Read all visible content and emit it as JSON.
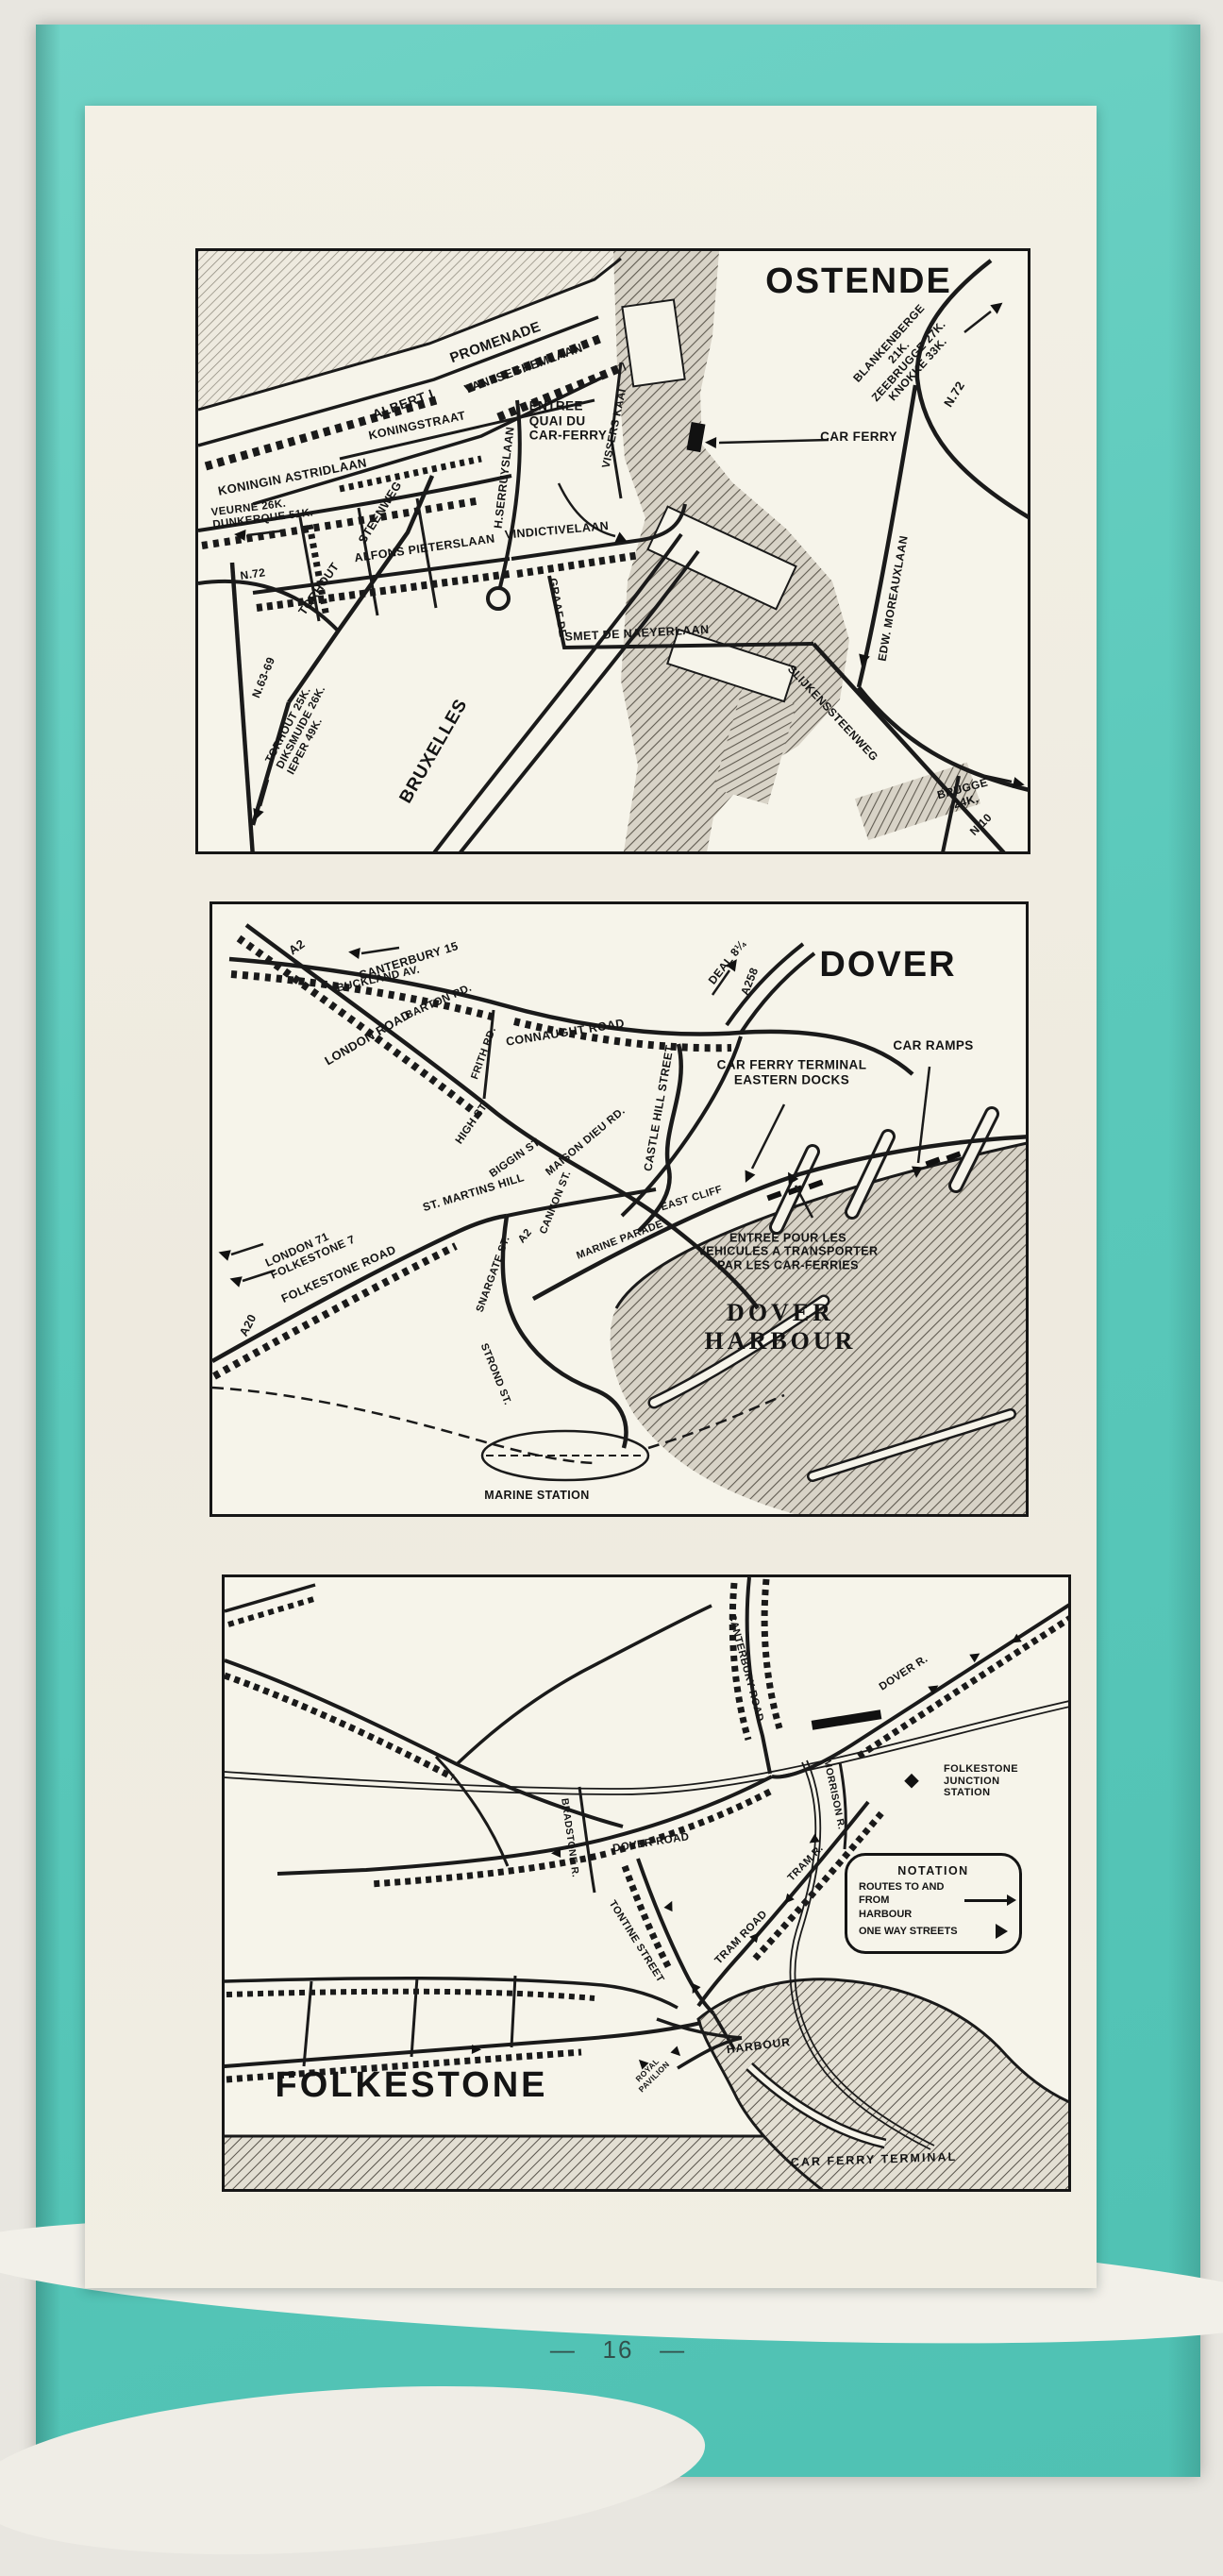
{
  "page": {
    "number_label": "—   16   —"
  },
  "colors": {
    "teal": "#5bc9bb",
    "paper": "#f2efe4",
    "ink": "#161616",
    "water_hatch": "#d8d3c7"
  },
  "maps": {
    "ostende": {
      "title": "OSTENDE",
      "labels": {
        "promenade": "PROMENADE",
        "albert": "ALBERT I",
        "van_iseghemlaan": "VAN ISEGHEMLAAN",
        "koningstraat": "KONINGSTRAAT",
        "entree": "ENTREE\nQUAI DU\nCAR-FERRY",
        "koningin_astridlaan": "KONINGIN ASTRIDLAAN",
        "veurne_dunkerque": "VEURNE 26K.\nDUNKERQUE 51K.",
        "h_serruyslaan": "H.SERRUYSLAAN",
        "vindictivelaan": "VINDICTIVELAAN",
        "alfons_pieterslaan": "ALFONS PIETERSLAAN",
        "steenweg": "STEENWEG",
        "torhout_street": "TORHOUT",
        "n72_left": "N.72",
        "n63_69": "N.63-69",
        "torhout_distances": "TORHOUT 25K.\nDIKSMUIDE 26K.\nIEPER 49K.",
        "bruxelles": "BRUXELLES",
        "vissers_kaai": "VISSERS KAAI",
        "car_ferry": "CAR FERRY",
        "blankenberge_knokke": "BLANKENBERGE 21K.\nZEEBRUGGE 27K.\nKNOKKE 33K.",
        "n72_right": "N.72",
        "graaf_de": "GRAAF DE",
        "smet_de_naeyerlaan": "SMET DE NAEYERLAAN",
        "slijkenssteenweg": "SLIJKENSSTEENWEG",
        "edw_moreauxlaan": "EDW. MOREAUXLAAN",
        "brugge": "BRUGGE 24K.",
        "n10": "N.10"
      }
    },
    "dover": {
      "title": "DOVER",
      "labels": {
        "a2_nw": "A2",
        "canterbury": "CANTERBURY 15",
        "buckland": "BUCKLAND AV.",
        "barton": "BARTON RD.",
        "london_road": "LONDON ROAD",
        "connaught": "CONNAUGHT ROAD",
        "frith": "FRITH RD.",
        "castle_hill": "CASTLE HILL STREET",
        "deal": "DEAL 8¼",
        "a258": "A258",
        "high_st": "HIGH ST.",
        "biggin": "BIGGIN ST.",
        "cannon": "CANNON ST.",
        "maison_dieu": "MAISON DIEU RD.",
        "st_martins": "ST. MARTINS HILL",
        "london_folkestone": "LONDON 71\nFOLKESTONE 7",
        "a20": "A20",
        "folkestone_road": "FOLKESTONE ROAD",
        "snargate": "SNARGATE ST.",
        "a2_snargate": "A2",
        "marine_parade": "MARINE PARADE",
        "east_cliff": "EAST CLIFF",
        "car_ferry_terminal": "CAR FERRY TERMINAL\nEASTERN DOCKS",
        "car_ramps": "CAR RAMPS",
        "entree": "ENTREE POUR LES\nVEHICULES A TRANSPORTER\nPAR LES CAR-FERRIES",
        "dover_harbour": "DOVER HARBOUR",
        "strond": "STROND ST.",
        "marine_station": "MARINE STATION"
      }
    },
    "folkestone": {
      "title": "FOLKESTONE",
      "labels": {
        "canterbury_road": "CANTERBURY ROAD",
        "dover_r": "DOVER R.",
        "junction_station": "FOLKESTONE\nJUNCTION STATION",
        "morrison": "MORRISON R.",
        "dover_road": "DOVER ROAD",
        "bradstone": "BRADSTONE R.",
        "tontine": "TONTINE STREET",
        "tram_road": "TRAM ROAD",
        "tram_r": "TRAM R.",
        "harbour": "HARBOUR",
        "royal_pavilion": "ROYAL\nPAVILION",
        "car_ferry_terminal": "CAR FERRY TERMINAL"
      },
      "notation": {
        "title": "NOTATION",
        "routes": "ROUTES TO AND FROM\nHARBOUR",
        "one_way": "ONE WAY STREETS"
      }
    }
  }
}
